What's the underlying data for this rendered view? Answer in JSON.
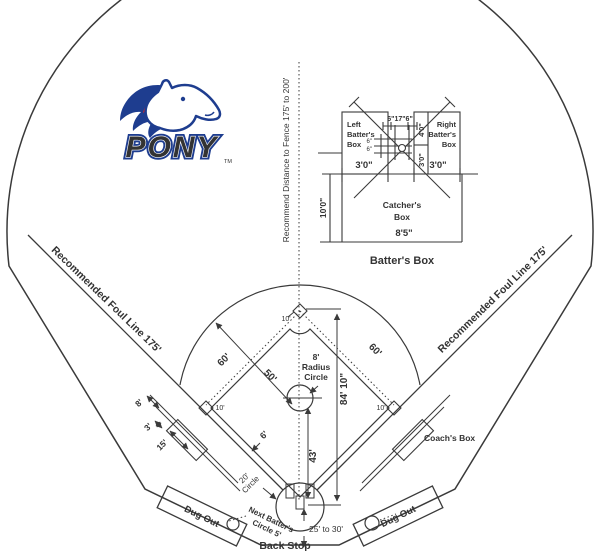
{
  "logo": {
    "wordmark": "PONY",
    "tm": "TM"
  },
  "labels": {
    "fence": "Recommend Distance to Fence 175' to 200'",
    "foul_left": "Recommended Foul Line 175'",
    "foul_right": "Recommended Foul Line 175'"
  },
  "inset": {
    "left_box_l1": "Left",
    "left_box_l2": "Batter's",
    "left_box_l3": "Box",
    "right_box_l1": "Right",
    "right_box_l2": "Batter's",
    "right_box_l3": "Box",
    "top_dim": "6\"17\"6\"",
    "front_depth": "4'0\"",
    "back_depth": "3'0\"",
    "left_width": "3'0\"",
    "right_width": "3'0\"",
    "gap_a": "6\"",
    "gap_b": "6\"",
    "catcher_depth": "10'0\"",
    "catcher_l1": "Catcher's",
    "catcher_l2": "Box",
    "catcher_width": "8'5\"",
    "caption": "Batter's Box"
  },
  "field": {
    "basepath_left": "60'",
    "basepath_right": "60'",
    "grass_radius": "50'",
    "circle_l1": "8'",
    "circle_l2": "Radius",
    "circle_l3": "Circle",
    "home_to_second": "84' 10\"",
    "pitch_dist": "43'",
    "path_width": "6'",
    "home_circle_l1": "20'",
    "home_circle_l2": "Circle",
    "second_r": "10'",
    "first_r": "10'",
    "third_r": "10'",
    "coach_box": "Coach's Box",
    "lane_8": "8'",
    "lane_3": "3'",
    "lane_15": "15'"
  },
  "bottom": {
    "dugout_left": "Dug Out",
    "dugout_right": "Dug Out",
    "next_batter_l1": "Next Batter's",
    "next_batter_l2": "Circle 5'",
    "backstop": "Back Stop",
    "backstop_dist": "25' to 30'"
  }
}
